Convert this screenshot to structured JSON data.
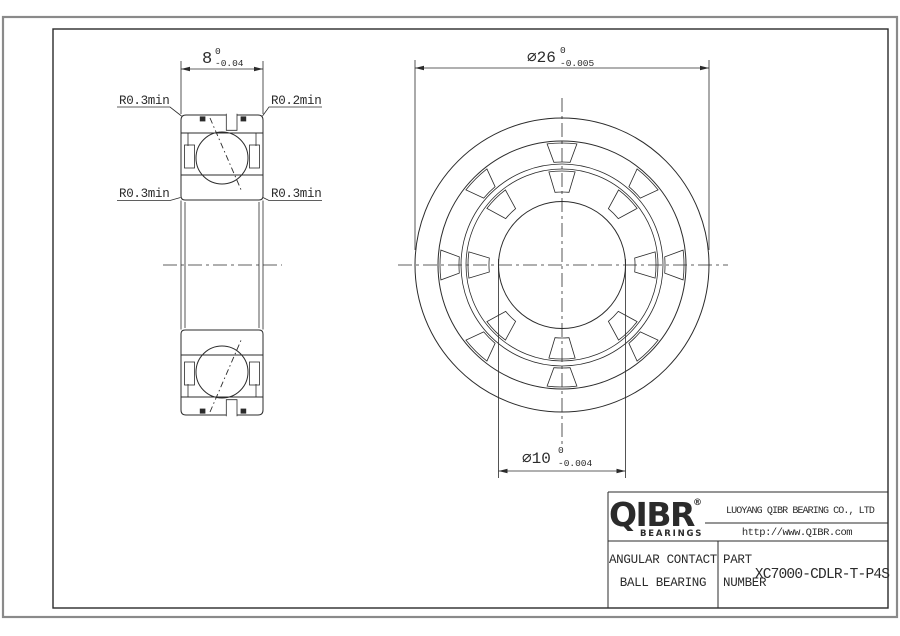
{
  "page": {
    "background": "#ffffff"
  },
  "drawing": {
    "section_view": {
      "width_dim": {
        "nominal": "8",
        "tol_upper": "0",
        "tol_lower": "-0.04"
      },
      "fillet_labels": {
        "outer_top_left": "R0.3min",
        "outer_top_right": "R0.2min",
        "inner_bottom_left": "R0.3min",
        "inner_bottom_right": "R0.3min"
      }
    },
    "front_view": {
      "outer_diameter_dim": {
        "nominal": "∅26",
        "tol_upper": "0",
        "tol_lower": "-0.005"
      },
      "bore_diameter_dim": {
        "nominal": "∅10",
        "tol_upper": "0",
        "tol_lower": "-0.004"
      }
    }
  },
  "title_block": {
    "logo_text": "QIBR",
    "logo_registered": "®",
    "logo_subtext": "BEARINGS",
    "company_name": "LUOYANG QIBR BEARING CO., LTD",
    "website": "http://www.QIBR.com",
    "product_name_line1": "ANGULAR CONTACT",
    "product_name_line2": "BALL BEARING",
    "part_label_line1": "PART",
    "part_label_line2": "NUMBER",
    "part_number": "XC7000-CDLR-T-P4S"
  },
  "colors": {
    "line": "#2b2b2b",
    "outer_border": "#8a8a8a",
    "paper": "#ffffff"
  }
}
